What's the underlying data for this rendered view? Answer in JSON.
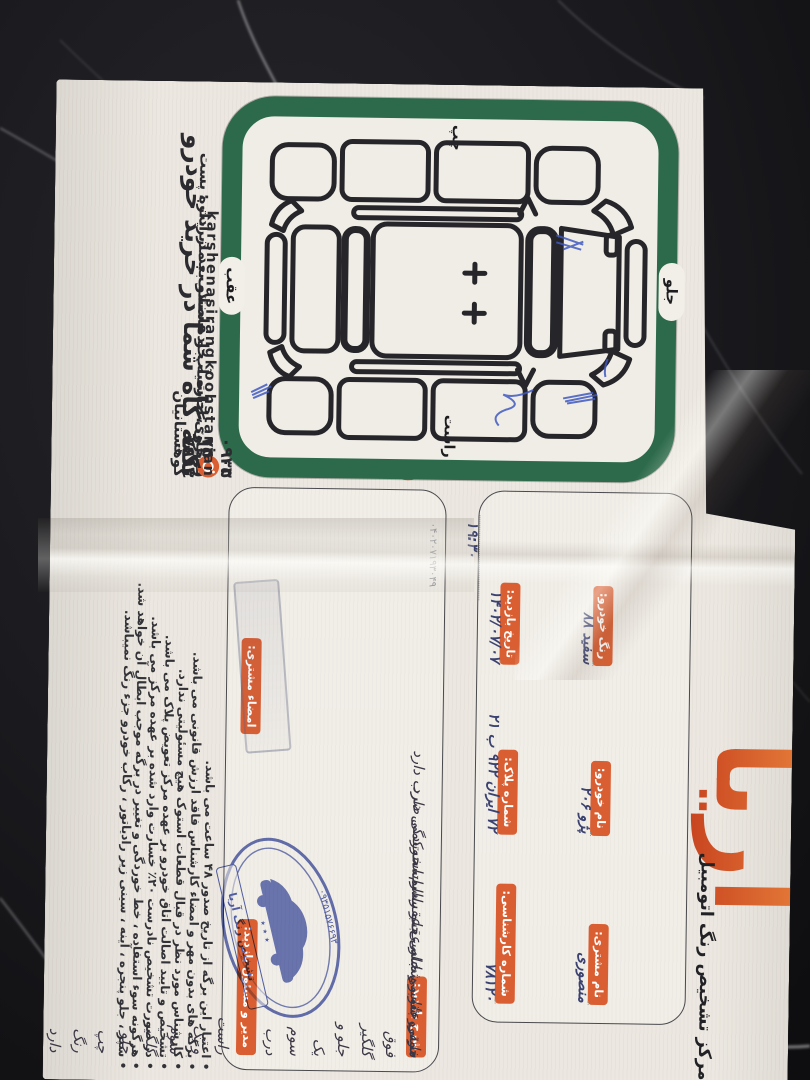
{
  "colors": {
    "accent_orange": "#d95f33",
    "frame_green": "#2d6a4b",
    "stamp_blue": "#4253a8",
    "pen_blue": "#3f58c0",
    "paper": "#ece8e1"
  },
  "header": {
    "title": "مرکز تشخیص رنگ اتومبیل",
    "logo": "آریا",
    "serial": "۰۴۰۲۰۷۱۹۳۰۴۹"
  },
  "fields": [
    {
      "label": "نام مشتری:",
      "value": "منصوری"
    },
    {
      "label": "نام خودرو:",
      "value": "پژو ۲۰۶"
    },
    {
      "label": "رنگ خودرو:",
      "value": "سفید ۸۸"
    },
    {
      "label": "شماره کارشناسی:",
      "value": "۷۸۱۲۰"
    },
    {
      "label": "شماره پلاک:",
      "value": "۷۲ ایران ۹۲۲ ب ۲۱"
    },
    {
      "label": "تاریخ بازدید:",
      "value": "۱۴۰۲/۰۷/۰۷",
      "time": "۱۹:۳۰"
    }
  ],
  "diagram": {
    "label_top": "جلو",
    "label_bottom": "عقب",
    "label_left": "چپ",
    "label_right": "راست"
  },
  "inspection": {
    "label": "شرح بازدید:",
    "lines": [
      "خودرو فوق گلگیر جلو و یک سوم درب جلو راست و یک سوم گلگیر جلو چپ رنگ دارد",
      "سینی جلو و شاسی جلو راست خوردگی دارد",
      "سینی عقب و شاسی عقب راست کمی ضرب دارد",
      "مابقی شاسی جلو عقب سالم است"
    ]
  },
  "signatures": {
    "manager_label": "مدیر و مسئول بازدید:",
    "customer_label": "امضاء مشتری:"
  },
  "stamp": {
    "org": "تشخیص رنگ آریا",
    "phone": "۰۹۳۵۱۵۷۶۶۹۳",
    "stars": "٭ ٭ ٭"
  },
  "terms": [
    "اعتبار این برگه از تاریخ صدور ۴۸ ساعت می باشد.",
    "برگه های بدون مهر و امضاء کارشناس فاقد ارزش قانونی می باشد.",
    "کارشناس مورد نظر در قبال قطعات استوک هیچ مسئولیتی ندارد.",
    "تشخیص و تایید اصالت اتاق خودرو بر عهده مرکز تعویض پلاک می باشد.",
    "در صورت تشخیص نادرست ۲۰٪ خسارت وارد شده بر عهده مرکز می باشد.",
    "هرگونه سوء استفاده ، خط خوردگی و تغییر در برگه موجب ابطال آن خواهد شد.",
    "سپر ، جلو پنجره ، آینه ، سینی زیر رادیاتور ، رکاب خودرو جزء رنگ نمیباشد."
  ],
  "footer": {
    "address_line1": "قوچان ، حاشیه جاده سنتو بعد از اداره پست",
    "address_line2": "روبروی اداره آب و فاضلاب . مدیریت : کوهستانیان",
    "phone1": "۰۹۳۵ ۱۵۷ ۶۶۹۳",
    "phone2": "۰۹۰۳ ۷۴۰ ۷۹۱۳",
    "instagram": "karshenasirangkoohstanian",
    "slogan": "تکیه گاه شما در خرید خودرو"
  }
}
